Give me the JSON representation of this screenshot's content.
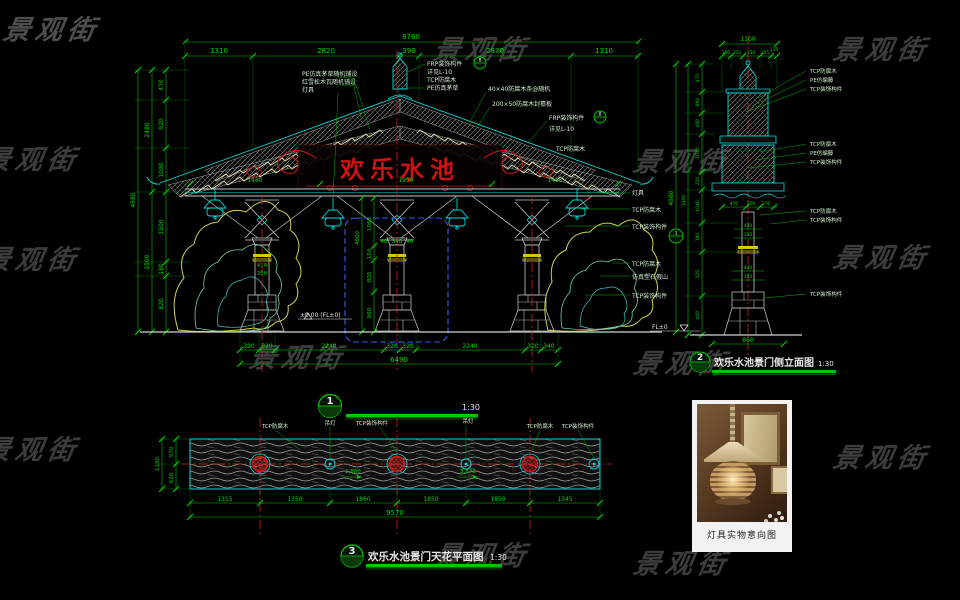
{
  "watermark": {
    "text": "景观街"
  },
  "front": {
    "bubble": "1",
    "title": "欢乐水池景门正立面图",
    "scale": "1:30",
    "banner": "欢乐水池",
    "level": "±0.00 (FL±0)",
    "callouts": [
      "8",
      "8",
      "1"
    ],
    "dims": {
      "top_total": "8760",
      "top": [
        "1310",
        "2820",
        "390",
        "2930",
        "1310"
      ],
      "left": [
        "470",
        "920",
        "1090",
        "1500",
        "180",
        "820"
      ],
      "left_sub": [
        "2480",
        "2500"
      ],
      "left_total": "4980",
      "right_total": "4980",
      "beam": [
        "1480",
        "1950",
        "1480"
      ],
      "bottom": [
        "390",
        "320",
        "2240",
        "320",
        "320",
        "2240",
        "320",
        "340"
      ],
      "bottom_total": "6490",
      "col": [
        "410",
        "350"
      ],
      "center_col": [
        "40",
        "340",
        "40"
      ],
      "center_chain": [
        "4800",
        "1065",
        "150",
        "800",
        "860"
      ]
    },
    "labels": {
      "roof_left": [
        "PE仿真茅草随机铺设",
        "红雪松木瓦随机铺设",
        "灯具"
      ],
      "finial": [
        "FRP装饰构件",
        "详见L-10",
        "TCP防腐木",
        "PE仿真茅草"
      ],
      "eave": [
        "40×40防腐木条@随机",
        "200×50防腐木封檐板",
        "FRP装饰构件",
        "详见L-10",
        "TCP防腐木"
      ],
      "right": [
        "灯具",
        "TCP防腐木",
        "TCP装饰构件",
        "TCP防腐木",
        "仿真塑石假山",
        "TCP装饰构件"
      ]
    }
  },
  "side": {
    "bubble": "2",
    "title": "欢乐水池景门侧立面图",
    "scale": "1:30",
    "level": "FL±0",
    "dims": {
      "top_total": "1100",
      "top": [
        "180",
        "235",
        "350",
        "225",
        "110"
      ],
      "left": [
        "470",
        "860",
        "450",
        "1040",
        "220",
        "1040",
        "180",
        "520",
        "400"
      ],
      "left_total": "5180",
      "eave": [
        "470",
        "350",
        "370"
      ],
      "col_upper": [
        "430",
        "350"
      ],
      "col_lower": [
        "440",
        "350"
      ],
      "base": "860"
    },
    "labels": [
      "TCP防腐木",
      "PE仿编藤",
      "TCP装饰构件",
      "TCP防腐木",
      "PE仿编藤",
      "TCP装饰构件",
      "TCP防腐木",
      "TCP装饰构件",
      "TCP装饰构件"
    ]
  },
  "plan": {
    "bubble": "3",
    "title": "欢乐水池景门天花平面图",
    "scale": "1:30",
    "dims": {
      "bottom": [
        "1315",
        "1350",
        "1860",
        "1850",
        "1850",
        "1345"
      ],
      "bottom_total": "9570",
      "left": [
        "570",
        "620"
      ],
      "left_total": "1190"
    },
    "labels": [
      "TCP防腐木",
      "吊灯",
      "TCP装饰构件",
      "吊灯",
      "TCP防腐木",
      "TCP装饰构件"
    ],
    "notes": [
      "1,800",
      "3,870"
    ]
  },
  "photo": {
    "caption": "灯具实物意向图"
  },
  "colors": {
    "dim_green": "#00dc00",
    "line_cyan": "#00d8d8",
    "center_red": "#d42020",
    "banner_red": "#cc1212",
    "band_yellow": "#d8c800",
    "watermark_gray": "#3c3c3c"
  }
}
